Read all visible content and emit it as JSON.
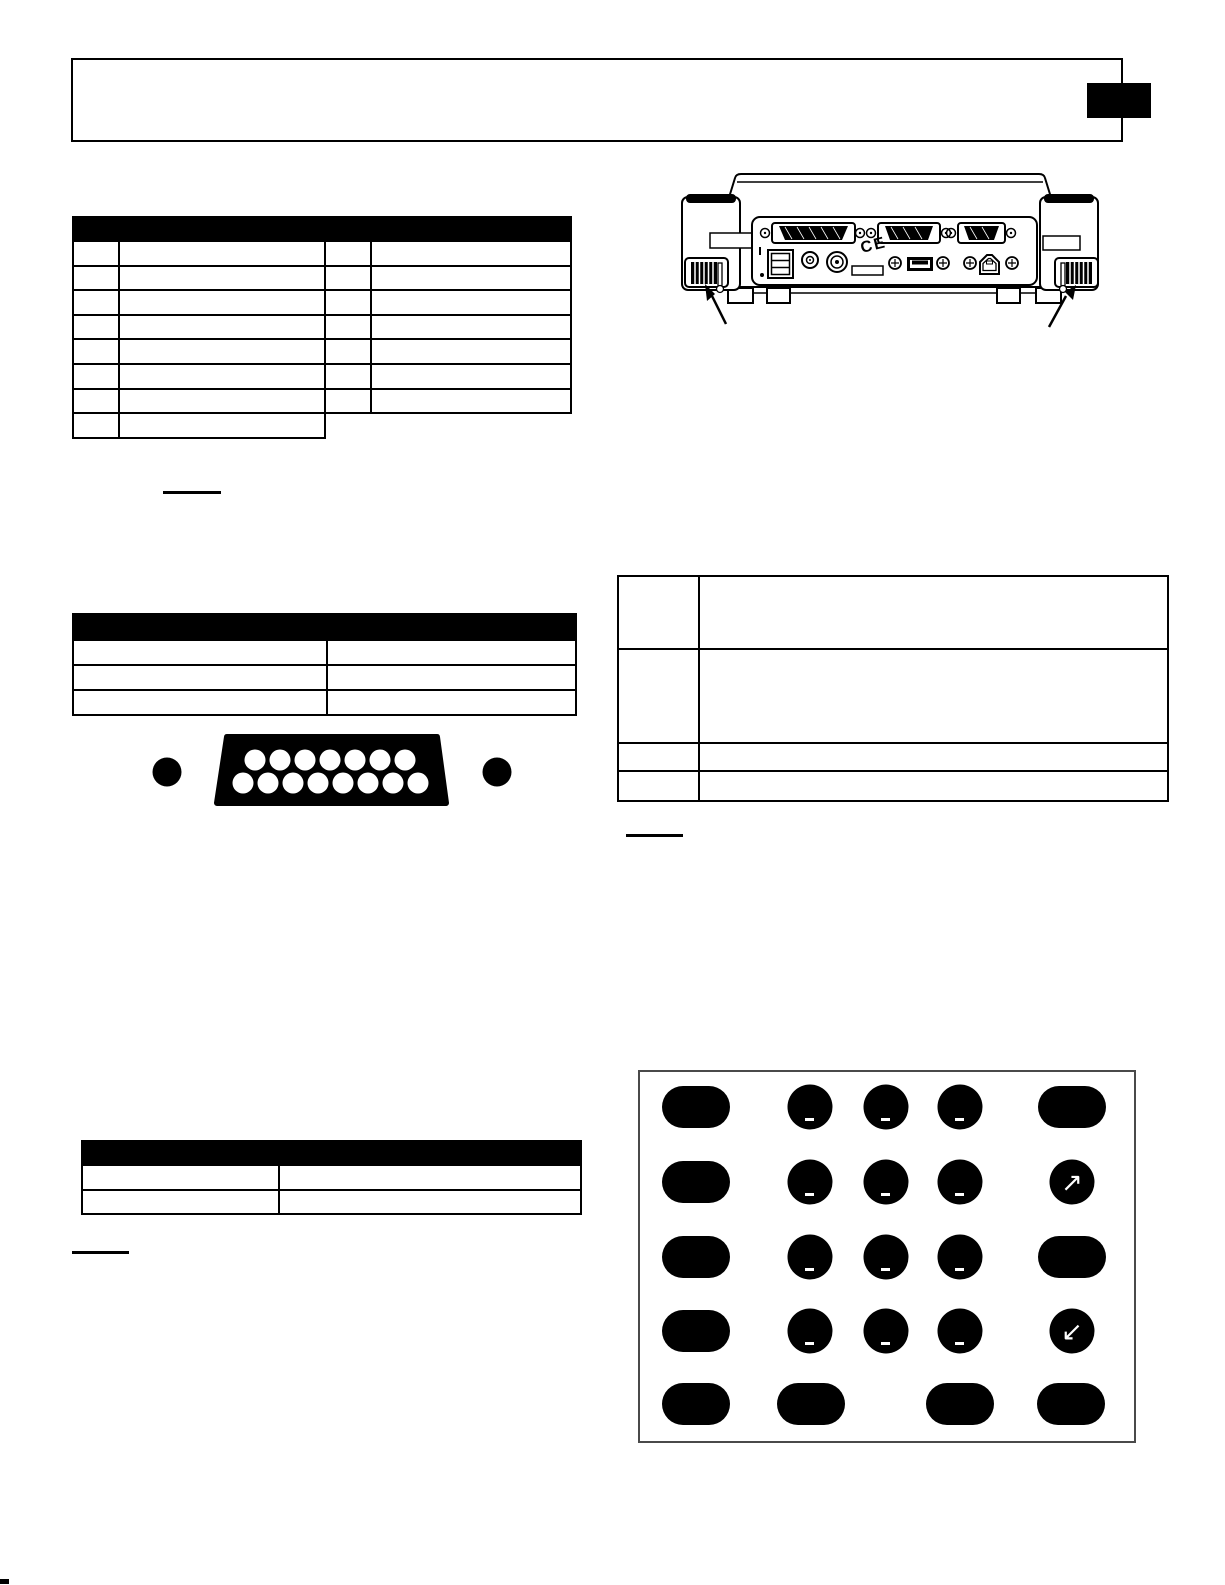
{
  "page": {
    "background": "#ffffff",
    "line_color": "#000000"
  },
  "header": {
    "title": "",
    "chapter_tab_color": "#000000"
  },
  "tables": {
    "legend": {
      "header_label": "",
      "rows": [
        [
          "",
          "",
          "",
          ""
        ],
        [
          "",
          "",
          "",
          ""
        ],
        [
          "",
          "",
          "",
          ""
        ],
        [
          "",
          "",
          "",
          ""
        ],
        [
          "",
          "",
          "",
          ""
        ],
        [
          "",
          "",
          "",
          ""
        ],
        [
          "",
          "",
          "",
          ""
        ],
        [
          "",
          "",
          null,
          null
        ]
      ]
    },
    "connector": {
      "header_label": "",
      "rows": [
        [
          "",
          ""
        ],
        [
          "",
          ""
        ],
        [
          "",
          ""
        ]
      ]
    },
    "description": {
      "rows": [
        [
          "",
          ""
        ],
        [
          "",
          ""
        ],
        [
          "",
          ""
        ],
        [
          "",
          ""
        ]
      ]
    },
    "bottom": {
      "header_label": "",
      "rows": [
        [
          "",
          ""
        ],
        [
          "",
          ""
        ]
      ]
    }
  },
  "device_rear_view": {
    "ce_mark": "CE"
  },
  "db15_connector": {
    "pins_top_row": 7,
    "pins_bottom_row": 8
  },
  "keypad": {
    "arrow_up_right": "↗",
    "arrow_down_left": "↙",
    "layout": [
      [
        "pill",
        "key",
        "key",
        "key",
        "pill"
      ],
      [
        "pill",
        "key",
        "key",
        "key",
        "arrow-ne"
      ],
      [
        "pill",
        "key",
        "key",
        "key",
        "pill"
      ],
      [
        "pill",
        "key",
        "key",
        "key",
        "arrow-sw"
      ],
      [
        "pill",
        "pill",
        "pill",
        "pill"
      ]
    ]
  }
}
